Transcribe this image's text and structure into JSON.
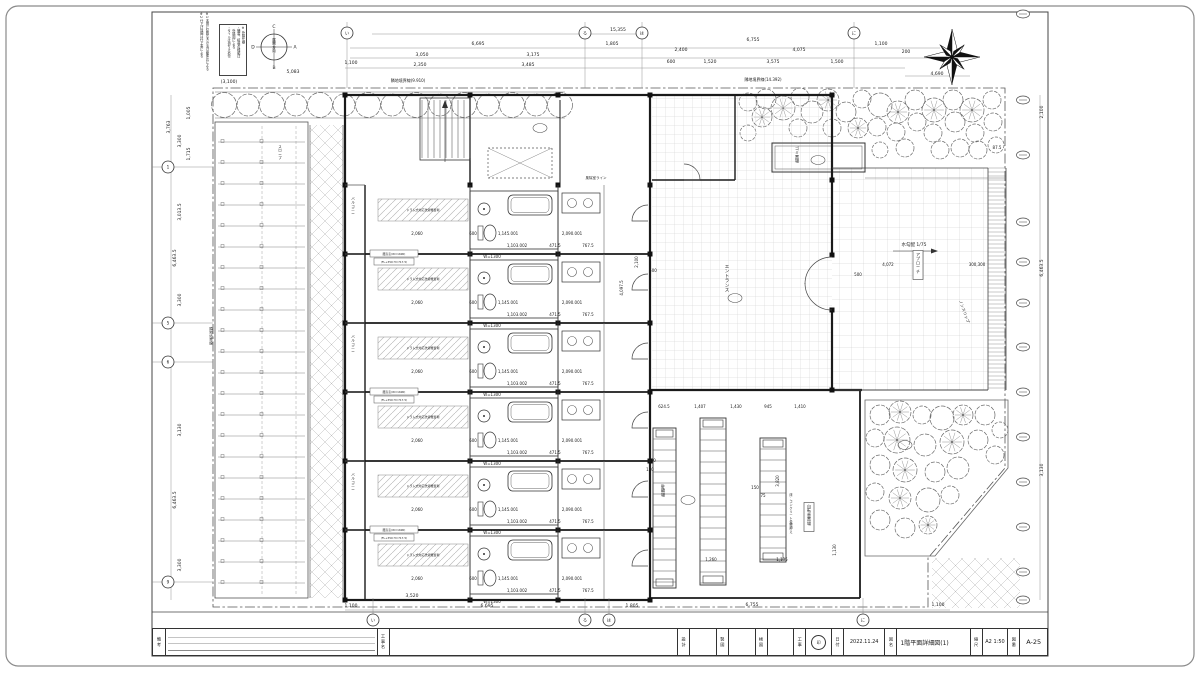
{
  "sheet": {
    "bg": "#ffffff",
    "frame_color": "#444444",
    "accent": "#1a1a1a"
  },
  "title_block": {
    "notes_label": "備考",
    "project_label": "工事名",
    "design_label": "設計",
    "draft_label": "製図",
    "check_label": "検図",
    "work_label": "工事",
    "stamp": "印",
    "date_label": "日付",
    "date": "2022.11.24",
    "name_label": "図名",
    "name": "1階平面詳細図(1)",
    "scale_label": "縮尺",
    "scale": "A2 1:50",
    "no_label": "図番",
    "no": "A-25"
  },
  "notes": {
    "note_box": "※ 外構仕様\n・舗装、植栽の種類は\n　外構図による\n・タイルは滑り止め付",
    "margin_notes": "※1 本図に記載なき寸法は躯体芯による\n※2 仕上げ詳細は仕上表による"
  },
  "direction_key": {
    "top": "C",
    "right": "A",
    "bottom": "B",
    "left": "D",
    "center": "展開方向"
  },
  "bubbles": {
    "top": [
      {
        "l": "い",
        "x": 347
      },
      {
        "l": "ろ",
        "x": 585
      },
      {
        "l": "は",
        "x": 642
      },
      {
        "l": "に",
        "x": 854
      }
    ],
    "bottom": [
      {
        "l": "い",
        "x": 373
      },
      {
        "l": "ろ",
        "x": 585
      },
      {
        "l": "は",
        "x": 609
      },
      {
        "l": "に",
        "x": 863
      }
    ],
    "left": [
      {
        "l": "1",
        "y": 167
      },
      {
        "l": "5",
        "y": 323
      },
      {
        "l": "6",
        "y": 362
      },
      {
        "l": "9",
        "y": 582
      }
    ]
  },
  "dims": {
    "top": [
      {
        "t": "15,355",
        "x": 618,
        "y": 31
      },
      {
        "t": "6,695",
        "x": 478,
        "y": 45
      },
      {
        "t": "1,805",
        "x": 612,
        "y": 45
      },
      {
        "t": "6,755",
        "x": 753,
        "y": 41
      },
      {
        "t": "1,100",
        "x": 881,
        "y": 45
      },
      {
        "t": "3,050",
        "x": 422,
        "y": 56
      },
      {
        "t": "3,175",
        "x": 533,
        "y": 56
      },
      {
        "t": "2,400",
        "x": 681,
        "y": 51
      },
      {
        "t": "4,075",
        "x": 799,
        "y": 51
      },
      {
        "t": "200",
        "x": 906,
        "y": 53
      },
      {
        "t": "1,100",
        "x": 351,
        "y": 64
      },
      {
        "t": "2,350",
        "x": 420,
        "y": 66
      },
      {
        "t": "3,485",
        "x": 528,
        "y": 66
      },
      {
        "t": "600",
        "x": 671,
        "y": 63
      },
      {
        "t": "1,520",
        "x": 710,
        "y": 63
      },
      {
        "t": "3,575",
        "x": 773,
        "y": 63
      },
      {
        "t": "1,500",
        "x": 837,
        "y": 63
      },
      {
        "t": "4,690",
        "x": 937,
        "y": 75
      },
      {
        "t": "5,083",
        "x": 293,
        "y": 73
      },
      {
        "t": "(3,100)",
        "x": 229,
        "y": 83
      }
    ],
    "bottom": [
      {
        "t": "1,100",
        "x": 351,
        "y": 607
      },
      {
        "t": "3,520",
        "x": 412,
        "y": 597
      },
      {
        "t": "6,695",
        "x": 487,
        "y": 607
      },
      {
        "t": "1,805",
        "x": 632,
        "y": 607
      },
      {
        "t": "6,755",
        "x": 752,
        "y": 606
      },
      {
        "t": "1,100",
        "x": 938,
        "y": 606
      }
    ],
    "left": [
      {
        "t": "1,005",
        "x": 190,
        "y": 113
      },
      {
        "t": "3,763",
        "x": 170,
        "y": 127
      },
      {
        "t": "3,300",
        "x": 181,
        "y": 141
      },
      {
        "t": "1,715",
        "x": 190,
        "y": 154
      },
      {
        "t": "3,013.5",
        "x": 181,
        "y": 212
      },
      {
        "t": "6,463.5",
        "x": 176,
        "y": 258
      },
      {
        "t": "3,300",
        "x": 181,
        "y": 300
      },
      {
        "t": "3,130",
        "x": 181,
        "y": 430
      },
      {
        "t": "6,463.5",
        "x": 176,
        "y": 500
      },
      {
        "t": "3,300",
        "x": 181,
        "y": 565
      }
    ],
    "right": [
      {
        "t": "2,100",
        "x": 1043,
        "y": 112
      },
      {
        "t": "6,463.5",
        "x": 1043,
        "y": 268
      },
      {
        "t": "3,130",
        "x": 1043,
        "y": 470
      }
    ],
    "inner": [
      {
        "t": "4,072",
        "x": 888,
        "y": 266
      },
      {
        "t": "300,300",
        "x": 977,
        "y": 266
      },
      {
        "t": "500",
        "x": 858,
        "y": 276
      },
      {
        "t": "87.5",
        "x": 997,
        "y": 149
      },
      {
        "t": "624.5",
        "x": 664,
        "y": 408
      },
      {
        "t": "1,407",
        "x": 700,
        "y": 408
      },
      {
        "t": "1,430",
        "x": 736,
        "y": 408
      },
      {
        "t": "945",
        "x": 768,
        "y": 408
      },
      {
        "t": "1,410",
        "x": 800,
        "y": 408
      },
      {
        "t": "2,100",
        "x": 638,
        "y": 262,
        "rot": true
      },
      {
        "t": "4,097.5",
        "x": 623,
        "y": 288,
        "rot": true
      },
      {
        "t": "500",
        "x": 653,
        "y": 272
      },
      {
        "t": "3,820",
        "x": 779,
        "y": 481,
        "rot": true
      },
      {
        "t": "1,130",
        "x": 836,
        "y": 550,
        "rot": true
      },
      {
        "t": "1,260",
        "x": 711,
        "y": 561
      },
      {
        "t": "1,135",
        "x": 782,
        "y": 561
      },
      {
        "t": "560",
        "x": 652,
        "y": 462
      },
      {
        "t": "150",
        "x": 650,
        "y": 471
      },
      {
        "t": "150",
        "x": 755,
        "y": 489
      },
      {
        "t": "75",
        "x": 763,
        "y": 497
      }
    ]
  },
  "unit": {
    "count": 6,
    "dims": [
      {
        "t": "2,060",
        "x": 417,
        "dy": 50
      },
      {
        "t": "600",
        "x": 473,
        "dy": 50
      },
      {
        "t": "1,145.001",
        "x": 508,
        "dy": 50
      },
      {
        "t": "2,090.001",
        "x": 572,
        "dy": 50
      },
      {
        "t": "1,103.002",
        "x": 517,
        "dy": 62
      },
      {
        "t": "471.5",
        "x": 555,
        "dy": 62
      },
      {
        "t": "767.5",
        "x": 588,
        "dy": 62
      },
      {
        "t": "W=1300",
        "x": 492,
        "dy": 73
      }
    ],
    "laundry_label": "ドラム式対応洗濯機置場",
    "window_label_1": "腰高窓(W=1690)",
    "window_label_2": "(FL+350 H=717.5)"
  },
  "site_labels": [
    {
      "t": "隣地境界線(9.910)",
      "x": 408,
      "y": 82,
      "s": 4
    },
    {
      "t": "隣地境界線(14.392)",
      "x": 763,
      "y": 81,
      "s": 4
    },
    {
      "t": "隣地境界線",
      "x": 211,
      "y": 330,
      "v": true,
      "s": 3.5
    },
    {
      "t": "エントランス",
      "x": 727,
      "y": 268,
      "v": true,
      "s": 4.5
    },
    {
      "t": "アプローチ",
      "x": 918,
      "y": 256,
      "v": true,
      "box": true,
      "s": 4
    },
    {
      "t": "水勾配 1/75",
      "x": 914,
      "y": 246,
      "s": 4.5
    },
    {
      "t": "ノンスリップ",
      "x": 963,
      "y": 312,
      "rot": 70,
      "s": 4
    },
    {
      "t": "風除室ライン",
      "x": 596,
      "y": 179,
      "s": 3.5
    },
    {
      "t": "ゴミ置場",
      "x": 797,
      "y": 150,
      "v": true,
      "s": 4
    },
    {
      "t": "駐輪場",
      "x": 663,
      "y": 488,
      "v": true,
      "s": 4
    },
    {
      "t": "自転車置場",
      "x": 809,
      "y": 508,
      "v": true,
      "box": true,
      "s": 4
    },
    {
      "t": "床：コンクリート金鏝押え",
      "x": 791,
      "y": 496,
      "v": true,
      "s": 3.2
    },
    {
      "t": "スロープ",
      "x": 280,
      "y": 148,
      "v": true,
      "s": 3.5
    },
    {
      "t": "バルコニー",
      "x": 353,
      "y": 200,
      "v": true,
      "s": 3.5
    },
    {
      "t": "バルコニー",
      "x": 353,
      "y": 338,
      "v": true,
      "s": 3.5
    },
    {
      "t": "バルコニー",
      "x": 353,
      "y": 476,
      "v": true,
      "s": 3.5
    }
  ]
}
